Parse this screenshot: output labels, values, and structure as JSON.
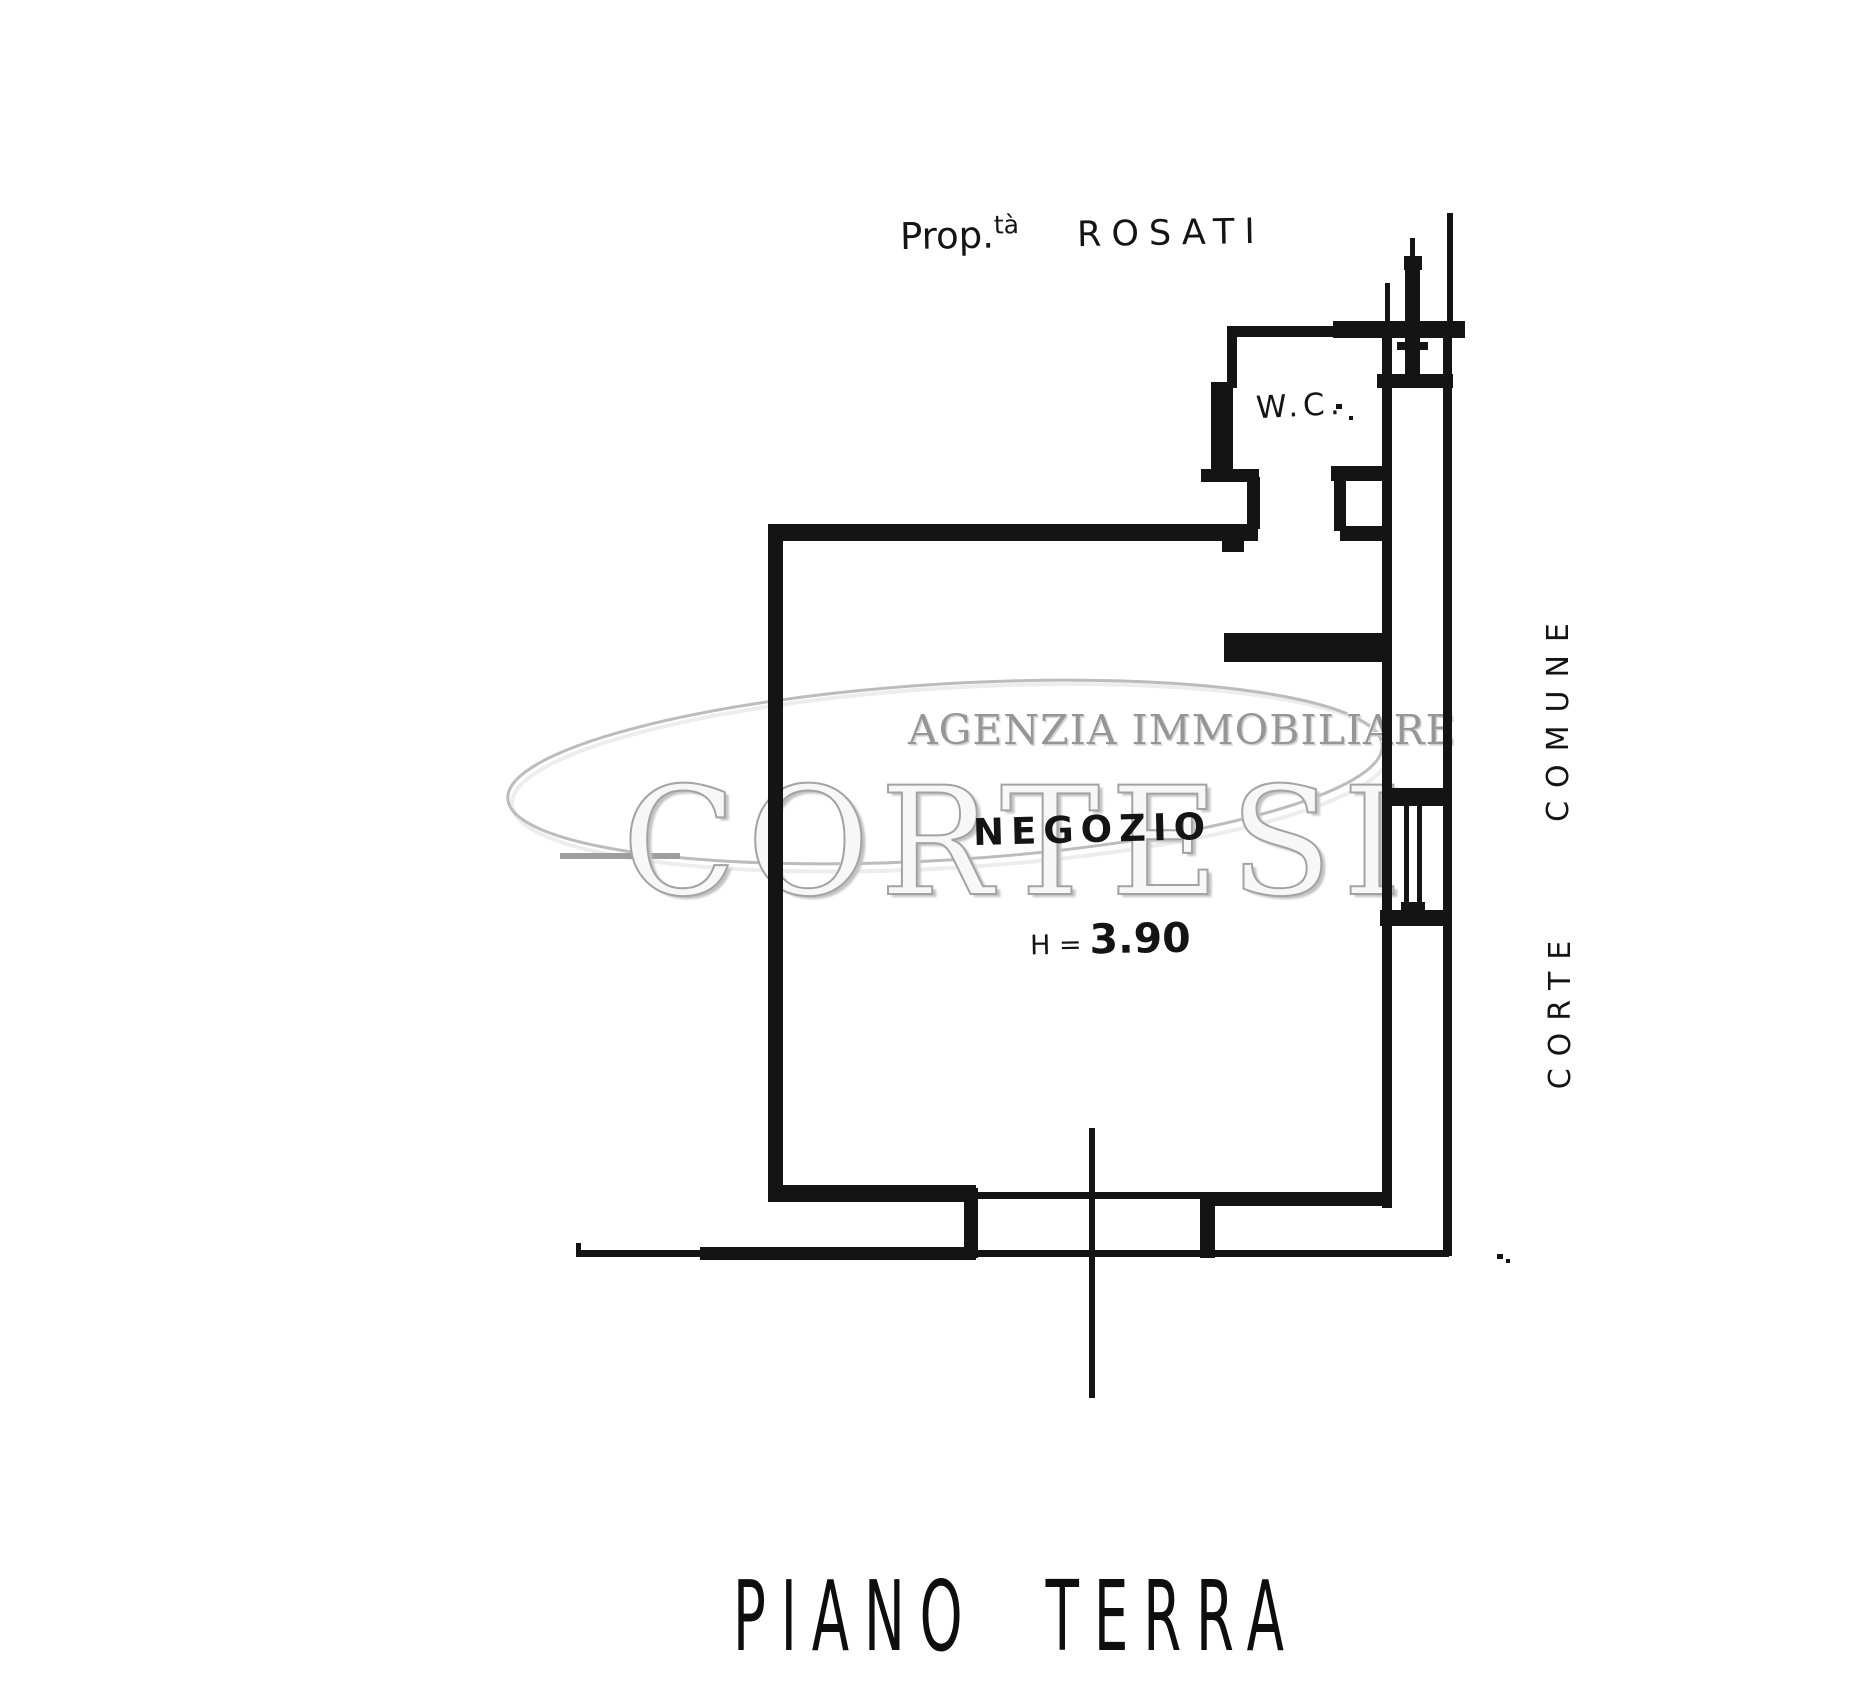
{
  "labels": {
    "property_prefix": "Prop.",
    "property_superscript": "tà",
    "property_name": "ROSATI",
    "wc": "W.C.",
    "room_name": "NEGOZIO",
    "height_prefix": "H =",
    "height_value": "3.90",
    "courtyard_word_top": "COMUNE",
    "courtyard_word_bottom": "CORTE",
    "floor_title": "PIANO TERRA"
  },
  "watermark": {
    "agency": "AGENZIA IMMOBILIARE",
    "brand": "CORTESI"
  },
  "colors": {
    "ink": "#141414",
    "paper": "#ffffff",
    "watermark_stroke": "#a3a3a3"
  }
}
